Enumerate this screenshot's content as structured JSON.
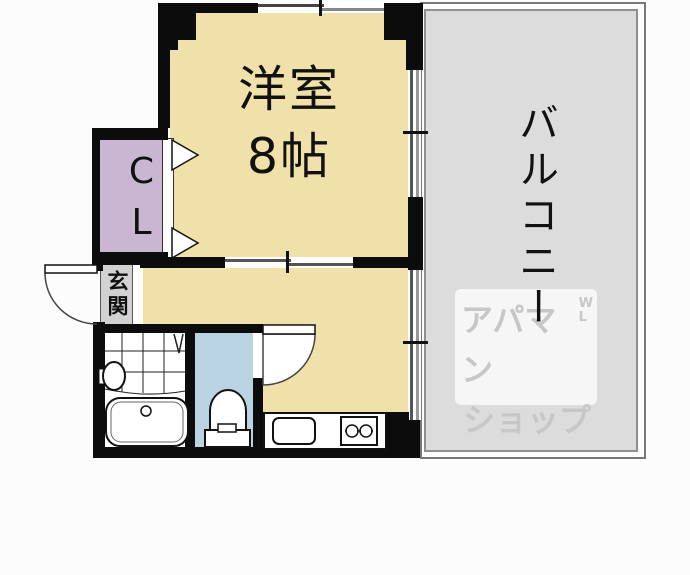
{
  "floorplan": {
    "main_room": {
      "name": "洋室",
      "size": "8帖"
    },
    "balcony": {
      "label": "バルコニー"
    },
    "closet": {
      "label": "CL"
    },
    "entrance": {
      "label": "玄関"
    },
    "watermark": {
      "line1": "アパマン",
      "line2": "ショップ",
      "mark_top": "W",
      "mark_bottom": "L"
    },
    "colors": {
      "room_floor": "#F0E1AA",
      "closet": "#C8B6D2",
      "balcony": "#DCDCDC",
      "toilet_room": "#B9D3E3",
      "entrance_strip": "#D2D2D2",
      "wall": "#0C0C0C",
      "window_line": "#777777",
      "watermark_text": "#C7C7C7"
    },
    "icons": {
      "bathtub-icon": "rounded-rect shape",
      "wash-basin-icon": "ellipse shape",
      "toilet-icon": "arch + tank shape",
      "kitchen-sink-icon": "rounded-rect shape",
      "stove-burners-icon": "two circles",
      "door-swing-icon": "quarter arc",
      "folding-door-icon": "triangles",
      "sliding-window-icon": "offset double lines"
    }
  }
}
